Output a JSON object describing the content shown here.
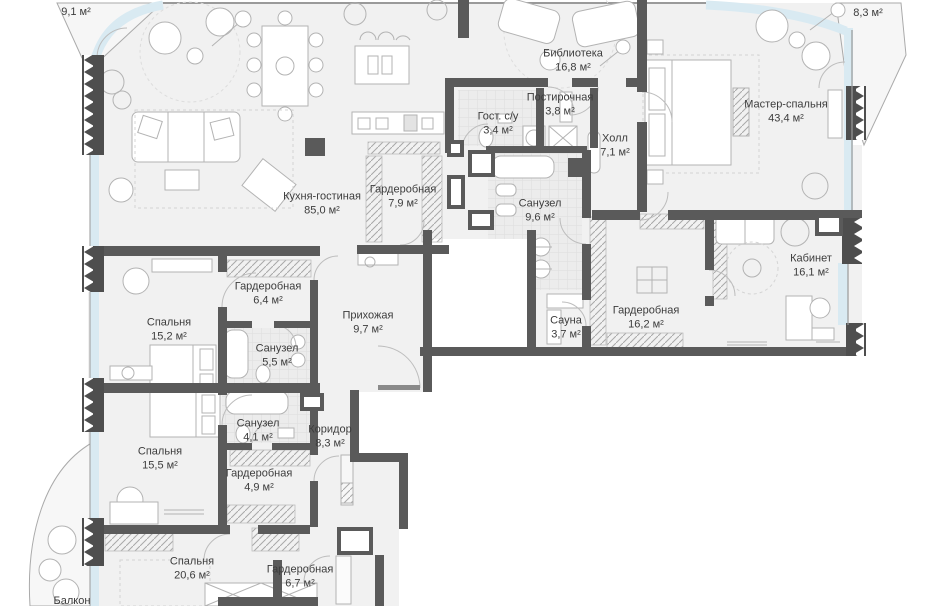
{
  "plan": {
    "type": "apartment-floor-plan",
    "language": "ru",
    "colors": {
      "wall": "#5a5a5a",
      "insulated_wall": "#4e4e4e",
      "floor": "#f1f1f1",
      "tile": "#ececec",
      "glass": "#d9eaf2",
      "furniture_stroke": "#b3b3b3",
      "hatch": "#a8a8a8",
      "label_text": "#3c3c3c",
      "outside": "#ffffff"
    },
    "rooms": [
      {
        "id": "terrace-top-left",
        "name": "",
        "area": "9,1 м²"
      },
      {
        "id": "terrace-top-right",
        "name": "",
        "area": "8,3 м²"
      },
      {
        "id": "library",
        "name": "Библиотека",
        "area": "16,8 м²"
      },
      {
        "id": "laundry",
        "name": "Постирочная",
        "area": "3,8 м²"
      },
      {
        "id": "guest-wc",
        "name": "Гост. с/у",
        "area": "3,4 м²"
      },
      {
        "id": "hall",
        "name": "Холл",
        "area": "7,1 м²"
      },
      {
        "id": "master-bedroom",
        "name": "Мастер-спальня",
        "area": "43,4 м²"
      },
      {
        "id": "kitchen-living",
        "name": "Кухня-гостиная",
        "area": "85,0 м²"
      },
      {
        "id": "wardrobe-kitchen",
        "name": "Гардеробная",
        "area": "7,9 м²"
      },
      {
        "id": "bathroom-master",
        "name": "Санузел",
        "area": "9,6 м²"
      },
      {
        "id": "study",
        "name": "Кабинет",
        "area": "16,1 м²"
      },
      {
        "id": "wardrobe-master",
        "name": "Гардеробная",
        "area": "16,2 м²"
      },
      {
        "id": "sauna",
        "name": "Сауна",
        "area": "3,7 м²"
      },
      {
        "id": "entry-hall",
        "name": "Прихожая",
        "area": "9,7 м²"
      },
      {
        "id": "wardrobe-2",
        "name": "Гардеробная",
        "area": "6,4 м²"
      },
      {
        "id": "bedroom-1",
        "name": "Спальня",
        "area": "15,2 м²"
      },
      {
        "id": "bathroom-2",
        "name": "Санузел",
        "area": "5,5 м²"
      },
      {
        "id": "bathroom-3",
        "name": "Санузел",
        "area": "4,1 м²"
      },
      {
        "id": "bedroom-2",
        "name": "Спальня",
        "area": "15,5 м²"
      },
      {
        "id": "wardrobe-3",
        "name": "Гардеробная",
        "area": "4,9 м²"
      },
      {
        "id": "corridor",
        "name": "Коридор",
        "area": "8,3 м²"
      },
      {
        "id": "bedroom-3",
        "name": "Спальня",
        "area": "20,6 м²"
      },
      {
        "id": "wardrobe-4",
        "name": "Гардеробная",
        "area": "6,7 м²"
      },
      {
        "id": "balcony",
        "name": "Балкон",
        "area": ""
      }
    ]
  }
}
